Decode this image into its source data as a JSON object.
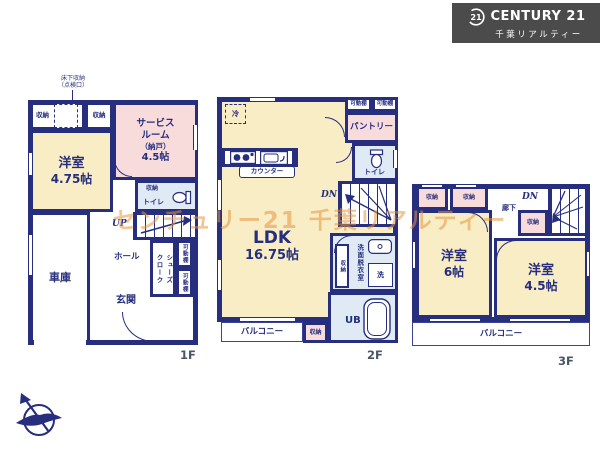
{
  "logo": {
    "badge": "21",
    "brand": "CENTURY 21",
    "subtitle": "千葉リアルティー"
  },
  "watermark": {
    "text": "センチュリー21 千葉リアルティー"
  },
  "labels": {
    "storage": "収納",
    "movable_shelf": "可動棚",
    "toilet": "トイレ",
    "balcony": "バルコニー",
    "western_room": "洋室",
    "up": "UP",
    "down": "DN"
  },
  "colors": {
    "wall": "#262e7d",
    "room_cream": "#f9edc5",
    "room_pink": "#f8dcdc",
    "room_blue": "#dfeaf4",
    "logo_bg": "#4b4b4b",
    "watermark": "#e6963e"
  },
  "floor1": {
    "floor_label": "1F",
    "underfloor_l1": "床下収納",
    "underfloor_l2": "（点検口）",
    "service_l1": "サービス",
    "service_l2": "ルーム",
    "service_l3": "（納戸）",
    "service_size": "4.5帖",
    "western_size": "4.75帖",
    "hall": "ホール",
    "shoes_l1": "シューズ",
    "shoes_l2": "クローク",
    "entrance": "玄関",
    "garage": "車庫"
  },
  "floor2": {
    "floor_label": "2F",
    "fridge": "冷",
    "pantry": "パントリー",
    "counter": "カウンター",
    "ldk": "LDK",
    "ldk_size": "16.75帖",
    "washroom": "洗面脱衣室",
    "washer": "洗",
    "unit_bath": "UB"
  },
  "floor3": {
    "floor_label": "3F",
    "corridor": "廊下",
    "room6_size": "6帖",
    "room45_size": "4.5帖"
  }
}
